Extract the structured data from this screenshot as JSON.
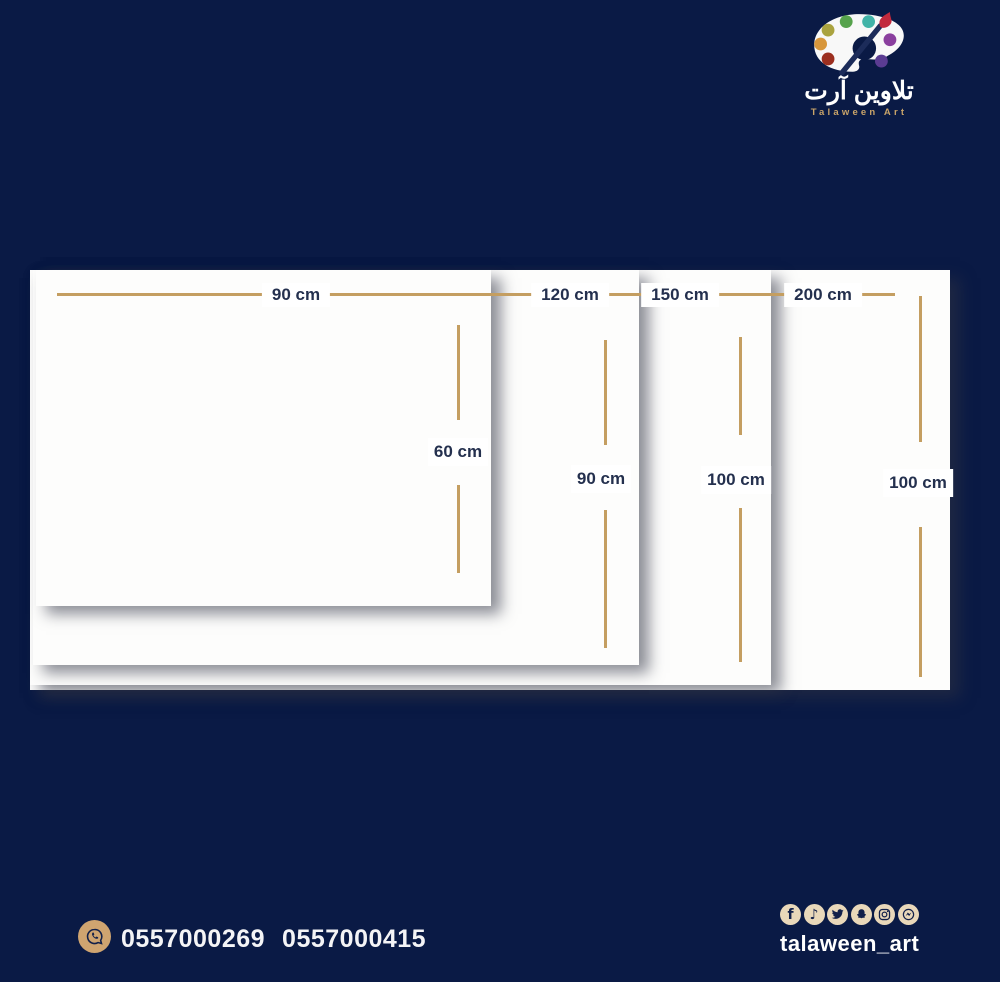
{
  "brand": {
    "logo_icon": "paint-palette-with-brush",
    "name_arabic": "تلاوين آرت",
    "name_latin": "Talaween Art"
  },
  "diagram": {
    "unit": "cm",
    "sizes": [
      {
        "name": "90x60",
        "width_label": "90 cm",
        "height_label": "60 cm"
      },
      {
        "name": "120x90",
        "width_label": "120 cm",
        "height_label": "90 cm"
      },
      {
        "name": "150x100",
        "width_label": "150 cm",
        "height_label": "100 cm"
      },
      {
        "name": "200x100",
        "width_label": "200 cm",
        "height_label": "100 cm"
      }
    ]
  },
  "contact": {
    "whatsapp_icon": "whatsapp-icon",
    "phone_primary": "0557000269",
    "phone_secondary": "0557000415"
  },
  "social": {
    "handle": "talaween_art",
    "icons": [
      "facebook",
      "tiktok",
      "twitter",
      "snapchat",
      "instagram",
      "messenger"
    ]
  },
  "colors": {
    "background": "#0a1a45",
    "ruler_gold": "#c49e61",
    "canvas_white": "#fdfdfc",
    "label_navy": "#24304e",
    "icon_cream": "#e9d8ba",
    "whatsapp_tan": "#cfa470"
  }
}
